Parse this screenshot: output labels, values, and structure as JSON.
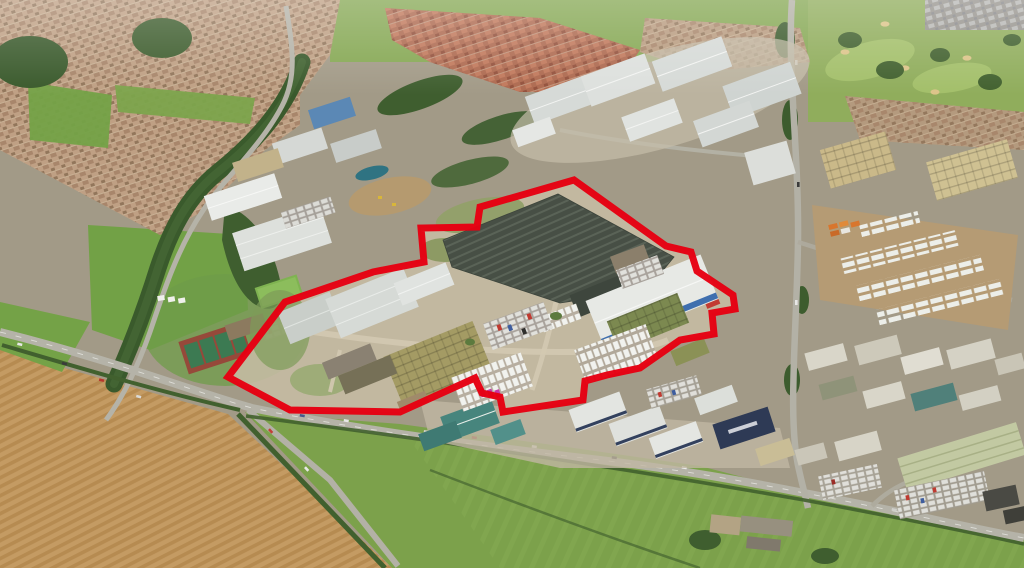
{
  "scene": {
    "type": "aerial-photograph",
    "subject": "Oblique aerial view of an industrial estate; a large factory site is outlined with a thick red boundary line. Surroundings: tan housing estates top-left, red-roofed new housing top-centre, golf course top-right, warehouse clusters centre and right, plowed farmland bottom-left, green fields along the bottom."
  },
  "boundary": {
    "color": "#e60012",
    "stroke_width": 7,
    "points": "574,180 666,246 691,252 697,271 733,295 735,309 712,313 714,334 680,340 640,368 607,375 585,381 583,400 503,412 500,397 482,393 475,378 400,412 290,410 228,377 285,302 373,272 424,262 421,228 477,227 480,207"
  },
  "colors": {
    "ground_base": "#a29a87",
    "farmland_plowed": "#c49b63",
    "furrow_dark": "#b68b51",
    "grass": "#7ca14b",
    "grass_bright": "#74a247",
    "field_top": "#86a854",
    "woodland": "#3a5a2c",
    "road": "#b5b3a8",
    "housing_tan": "#bfa084",
    "housing_red": "#ae6a50",
    "housing_gray": "#97948e",
    "golf_green": "#90ad5c",
    "bunker_sand": "#dcc489",
    "warehouse_light": "#d6dad7",
    "warehouse_white": "#e7e9e5",
    "factory_roof_dark": "#474f45",
    "khaki_shed": "#a49b64",
    "olive_shed": "#7c8950",
    "teal_roof": "#47857d",
    "navy_building": "#2e3a55",
    "blue_stripe": "#3f6fae",
    "truck_yard": "#b59b74",
    "concrete": "#c6bca4",
    "pond_teal": "#2f7382",
    "tan_warehouse": "#cab989",
    "sage_building": "#c2c9a2",
    "magenta_vans": "#c438a8"
  },
  "regions": {
    "site": "factory site outlined in red (dark sawtooth-roof factory, white warehouse with blue stripe, khaki sheds, van storage rows, offices)",
    "housing_nw": "tan residential estate, top-left",
    "housing_red_estate": "red-roofed housing estate, top-centre",
    "housing_ne_strip": "housing strip right of centre-top",
    "new_build": "new grey-roofed housing, top-right corner",
    "golf_course": "golf course with fairways and bunkers, top-right",
    "warehouses_north": "cluster of large grey gabled warehouses, top-centre",
    "warehouses_nw": "white warehouses west of the site",
    "tan_warehouses_ne": "tan warehouses, upper right",
    "truck_yard_east": "trailer and container yard, right",
    "industrial_south": "teal- and white-roofed trade units below the site",
    "industrial_se": "dense units and car lots, bottom-right",
    "sports_grounds": "playing field, tennis courts and bowling green, left",
    "plowed_field": "brown plowed farmland, bottom-left",
    "green_fields": "green pasture fields along the bottom",
    "main_road": "A-road running diagonally across the lower half with traffic",
    "pond": "small teal lagoon near the site's north-west corner"
  }
}
